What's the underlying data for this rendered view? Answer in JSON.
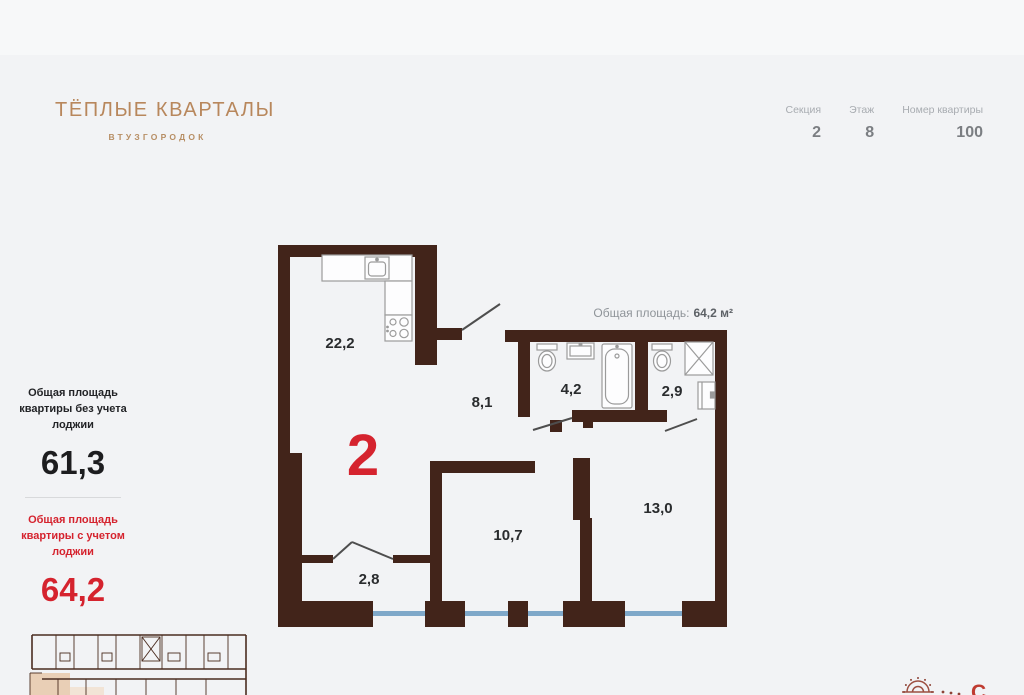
{
  "brand": {
    "title": "ТЁПЛЫЕ КВАРТАЛЫ",
    "subtitle": "ВТУЗГОРОДОК"
  },
  "header": {
    "stats": [
      {
        "label": "Секция",
        "value": "2"
      },
      {
        "label": "Этаж",
        "value": "8"
      },
      {
        "label": "Номер квартиры",
        "value": "100"
      }
    ]
  },
  "summary": {
    "without_loggia": {
      "label": "Общая площадь квартиры без учета лоджии",
      "value": "61,3"
    },
    "with_loggia": {
      "label": "Общая площадь квартиры с учетом лоджии",
      "value": "64,2"
    }
  },
  "plan": {
    "total_area_label": "Общая площадь:",
    "total_area_value": "64,2 м²",
    "rooms_count": "2",
    "rooms": [
      {
        "name": "kitchen-living-room",
        "area": "22,2"
      },
      {
        "name": "hallway",
        "area": "8,1"
      },
      {
        "name": "bathroom",
        "area": "4,2"
      },
      {
        "name": "wc",
        "area": "2,9"
      },
      {
        "name": "bedroom",
        "area": "13,0"
      },
      {
        "name": "room",
        "area": "10,7"
      },
      {
        "name": "loggia",
        "area": "2,8"
      }
    ]
  },
  "compass": {
    "north_label": "С"
  },
  "colors": {
    "wall_brown": "#42241a",
    "accent_red": "#d5232e",
    "brand_tan": "#b8875c",
    "window_blue": "#7fa8c9",
    "background": "#f2f3f5"
  }
}
